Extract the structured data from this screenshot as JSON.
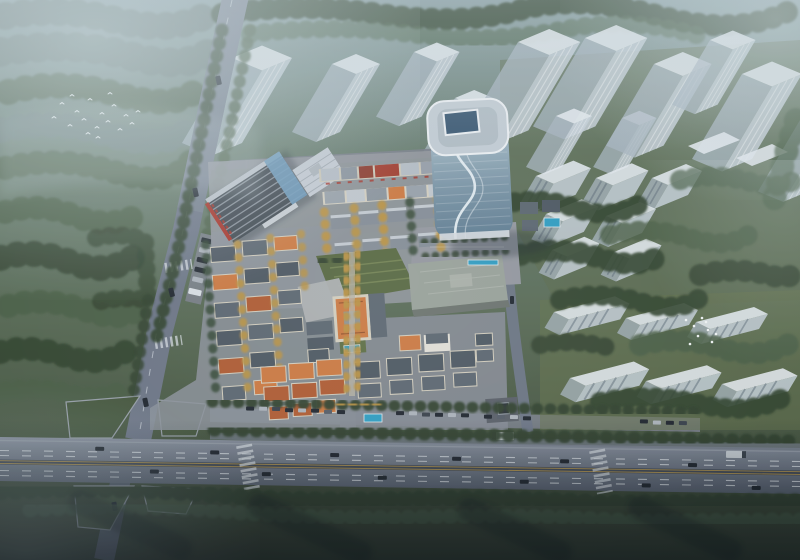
{
  "meta": {
    "title": "Aerial masterplan rendering",
    "canvas_width": 800,
    "canvas_height": 560
  },
  "scene": {
    "description": "Hazy bird's-eye architectural rendering of a mixed-use development: a curved blue-glass office tower with a rooftop skylight, a dark saw-tooth-roof commercial block with red signage, and a low-rise European-style village of slate and orange roofs with golden street trees, fronted by a tree-lined highway with traffic. Translucent white massing blocks of future residential towers and row housing surround the site, with misty forest, grass interchange islands, a flock of white birds over the woods and white egrets on a lawn.",
    "atmosphere": "cool dusk haze, fog in the corners, dark vignette along the bottom",
    "landmarks": [
      "curved glass office tower",
      "tower rooftop skylight",
      "saw-tooth roof commercial building with red signage",
      "retail lane with red awnings",
      "european-style village with slate and orange roofs",
      "orange-roof chateau clubhouse",
      "terraced central lawn",
      "orange-roof terraced villas",
      "slate-roof villas",
      "flat-roof exhibition hall",
      "translucent future residential towers",
      "translucent mid-rise blocks",
      "translucent row housing",
      "tree-lined avenue",
      "highway with cars and white trucks",
      "intersection with grass islands",
      "roadside parking with cars",
      "swimming pools and fountain",
      "misty forest",
      "flock of flying birds",
      "white egrets on lawn"
    ]
  },
  "colors": {
    "ground_haze": "#8aa0a4",
    "ground_upper": "#687d6e",
    "ground_mid": "#596b55",
    "ground_lower": "#46553f",
    "ground_dark": "#343f2d",
    "forest": "#31432f",
    "forest_light": "#4a5f46",
    "forest_hazy": "#6d7f7b",
    "tree_gold": "#bd9440",
    "lawn": "#5f7046",
    "road_light": "#8d95a2",
    "road_dark": "#5b6472",
    "road": "#6e7787",
    "line_white": "#dfe5ea",
    "line_yellow": "#c7a24e",
    "pavement": "#9599a0",
    "pavement_dark": "#7b818b",
    "ghost": "#c8d2da",
    "ghost_side": "#aab7c2",
    "ghost_roof": "#e6ebef",
    "tower_roof": "#c6cfd7",
    "tower_glass_1": "#a9bfca",
    "tower_glass_2": "#7d97a8",
    "tower_glass_3": "#5f7d92",
    "tower_swoosh": "#e8f0f4",
    "roof_slate": "#4e5862",
    "roof_slate_light": "#5d6771",
    "roof_orange": "#b25c31",
    "roof_orange_2": "#cf7a40",
    "wall": "#d6d0bf",
    "accent_red": "#a93125",
    "glass_blue": "#6f9cbe",
    "hall_roof": "#9ba39b",
    "hall_side": "#6c746e",
    "pool": "#2f9fc4",
    "car": "#20262e",
    "car_light": "#aeb5bc",
    "truck": "#dde2e6",
    "bird": "#f4f7f7",
    "fog": "#d3e0e4",
    "vignette": "#0a1017"
  }
}
